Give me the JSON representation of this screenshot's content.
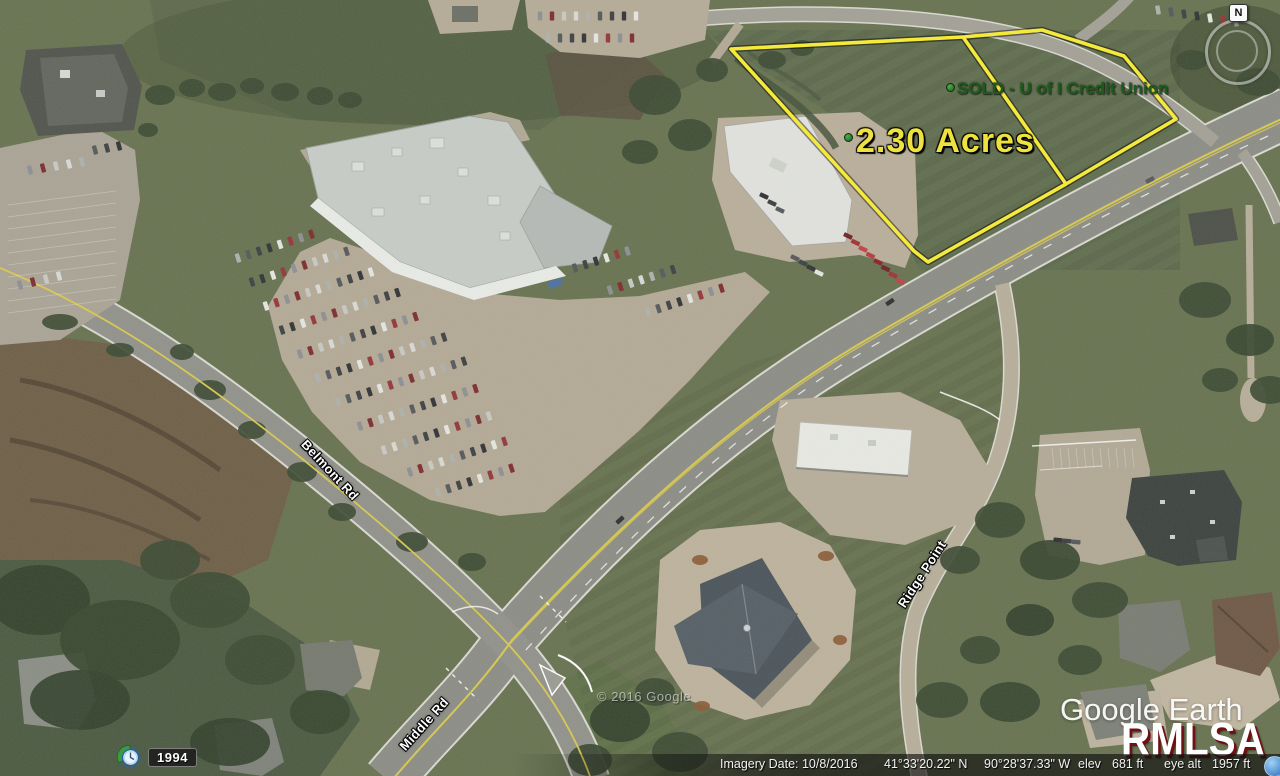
{
  "parcel": {
    "sold_label": "SOLD - U of I Credit Union",
    "acreage_label": "2.30 Acres",
    "outline_color": "#f5e93c",
    "sold_text_color": "#1d5b1d",
    "acreage_text_color": "#eee23f"
  },
  "roads": {
    "belmont": "Belmont Rd",
    "middle": "Middle Rd",
    "ridge": "Ridge Point"
  },
  "watermark": "© 2016 Google",
  "logos": {
    "google_earth": "Google Earth",
    "rmlsa": "RMLSA",
    "rmlsa_shadow_color": "#6f1113"
  },
  "compass": {
    "north": "N"
  },
  "timeline": {
    "year": "1994"
  },
  "status_bar": {
    "imagery_date": "Imagery Date: 10/8/2016",
    "latitude": "41°33'20.22\" N",
    "longitude": "90°28'37.33\" W",
    "elev_label": "elev",
    "elev_value": "681 ft",
    "eye_alt_label": "eye alt",
    "eye_alt_value": "1957 ft"
  }
}
